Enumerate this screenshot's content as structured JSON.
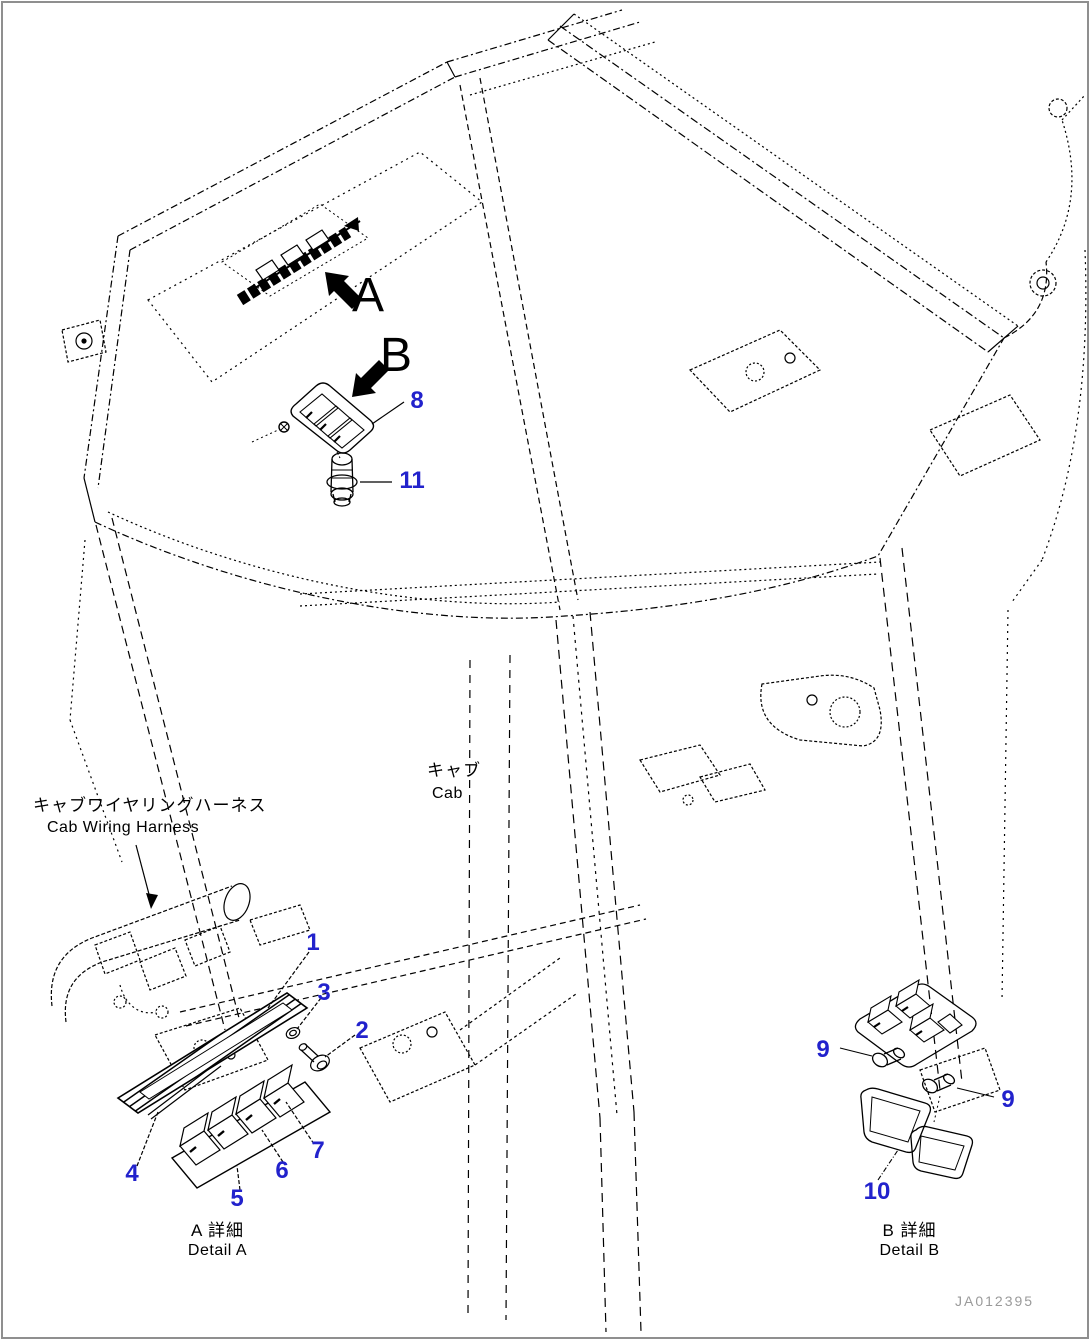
{
  "page": {
    "background": "#ffffff",
    "line_color": "#000000",
    "callout_color": "#2222cc",
    "code_color": "#9a9a9a"
  },
  "annotations": {
    "view_a": "A",
    "view_b": "B",
    "harness_label_jp": "キャブワイヤリングハーネス",
    "harness_label_en": "Cab Wiring Harness",
    "cab_label_jp": "キャブ",
    "cab_label_en": "Cab",
    "detail_a_jp": "A 詳細",
    "detail_a_en": "Detail A",
    "detail_b_jp": "B 詳細",
    "detail_b_en": "Detail B",
    "drawing_code": "JA012395"
  },
  "callouts": [
    {
      "number": "1"
    },
    {
      "number": "2"
    },
    {
      "number": "3"
    },
    {
      "number": "4"
    },
    {
      "number": "5"
    },
    {
      "number": "6"
    },
    {
      "number": "7"
    },
    {
      "number": "8"
    },
    {
      "number": "9"
    },
    {
      "number": "9"
    },
    {
      "number": "10"
    },
    {
      "number": "11"
    }
  ]
}
